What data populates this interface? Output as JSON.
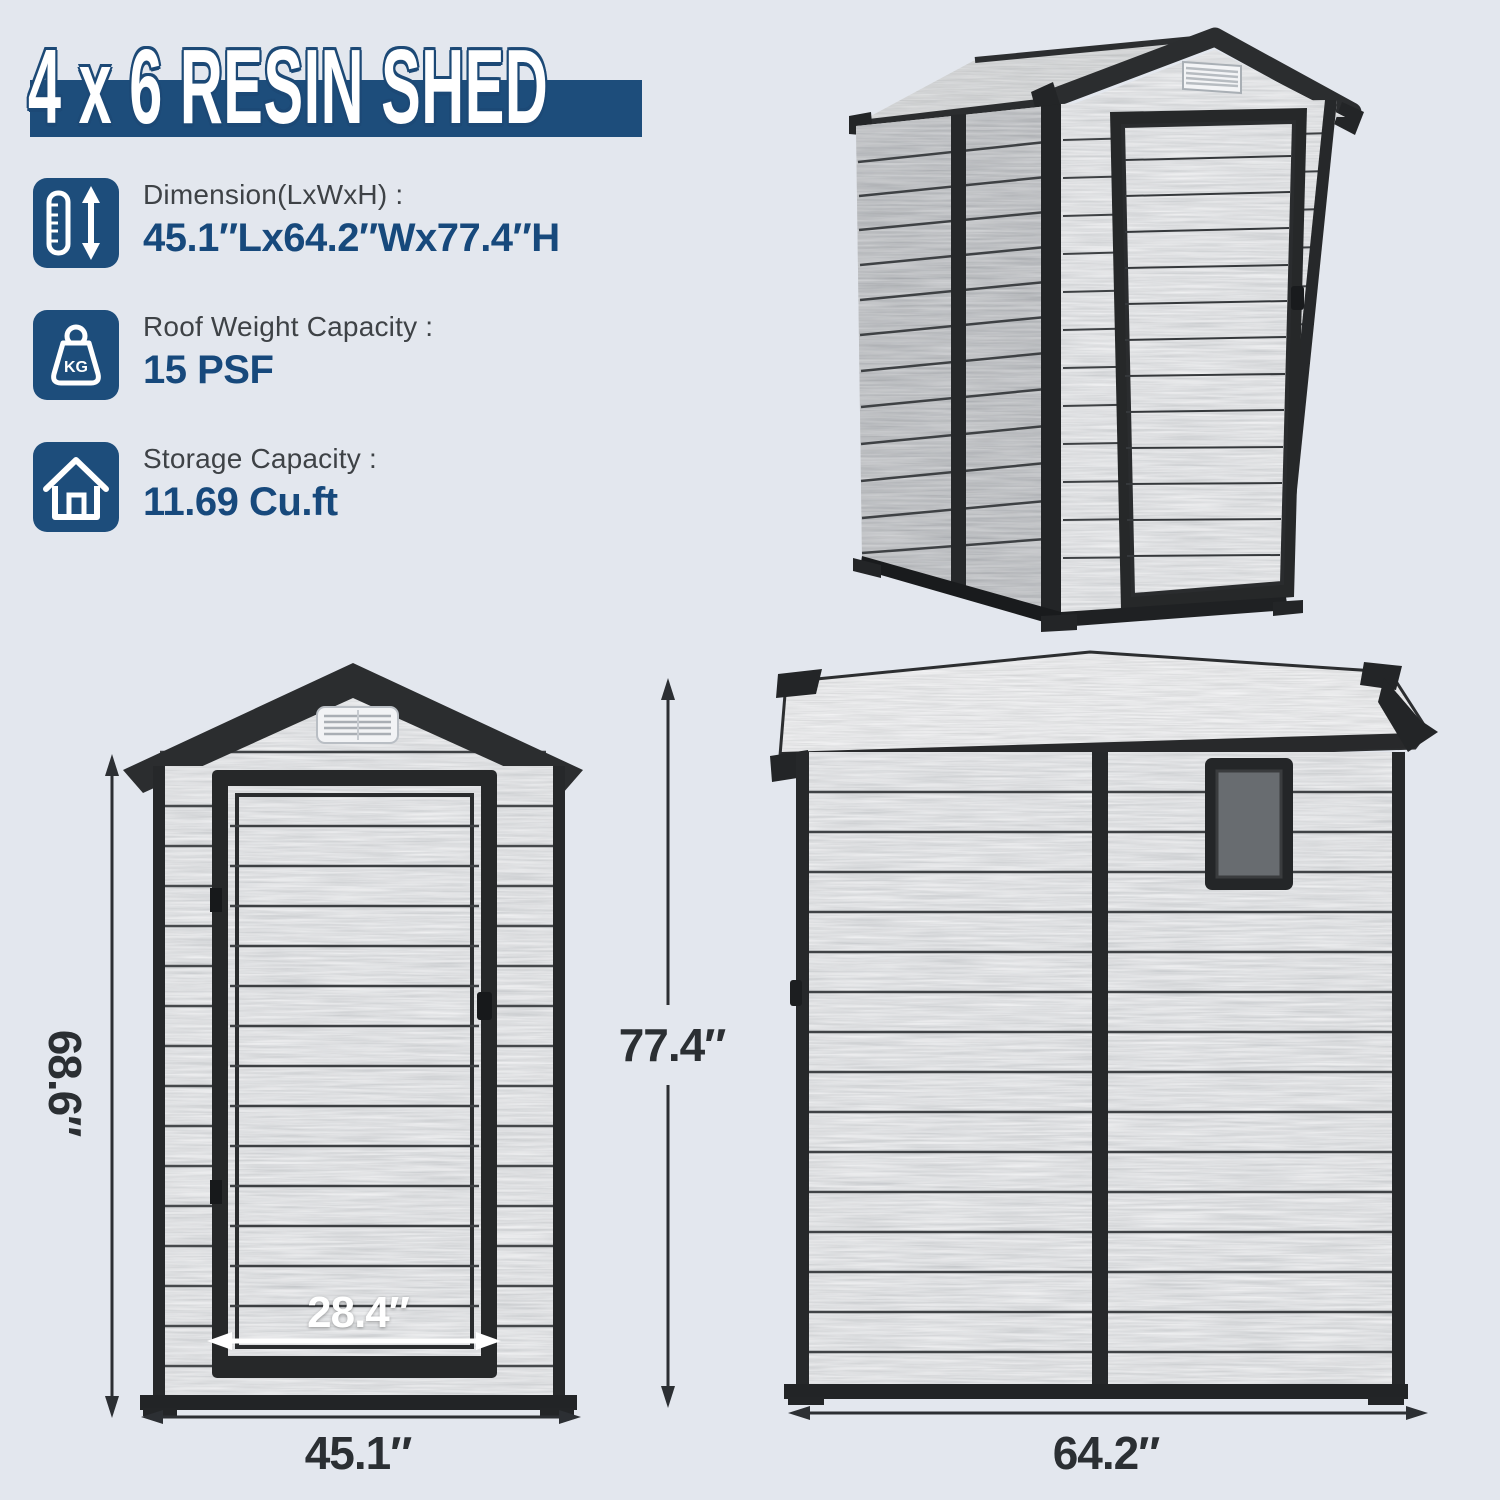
{
  "title": "4 x 6 RESIN SHED",
  "specs": [
    {
      "icon": "height-ruler-icon",
      "label": "Dimension(LxWxH) :",
      "value": "45.1″Lx64.2″Wx77.4″H"
    },
    {
      "icon": "weight-kg-icon",
      "icon_text": "KG",
      "label": "Roof Weight Capacity :",
      "value": "15 PSF"
    },
    {
      "icon": "house-storage-icon",
      "label": "Storage Capacity :",
      "value": "11.69 Cu.ft"
    }
  ],
  "views": {
    "iso": {
      "name": "3d perspective view of shed"
    },
    "front": {
      "height_label": "68.6″",
      "door_width_label": "28.4″",
      "width_label": "45.1″"
    },
    "side": {
      "height_label": "77.4″",
      "width_label": "64.2″"
    }
  },
  "colors": {
    "background": "#e3e7ee",
    "banner": "#1d4d7b",
    "value_text": "#17497c",
    "label_text": "#3e4246",
    "dim_text": "#2b2f33",
    "trim_black": "#26282a"
  }
}
